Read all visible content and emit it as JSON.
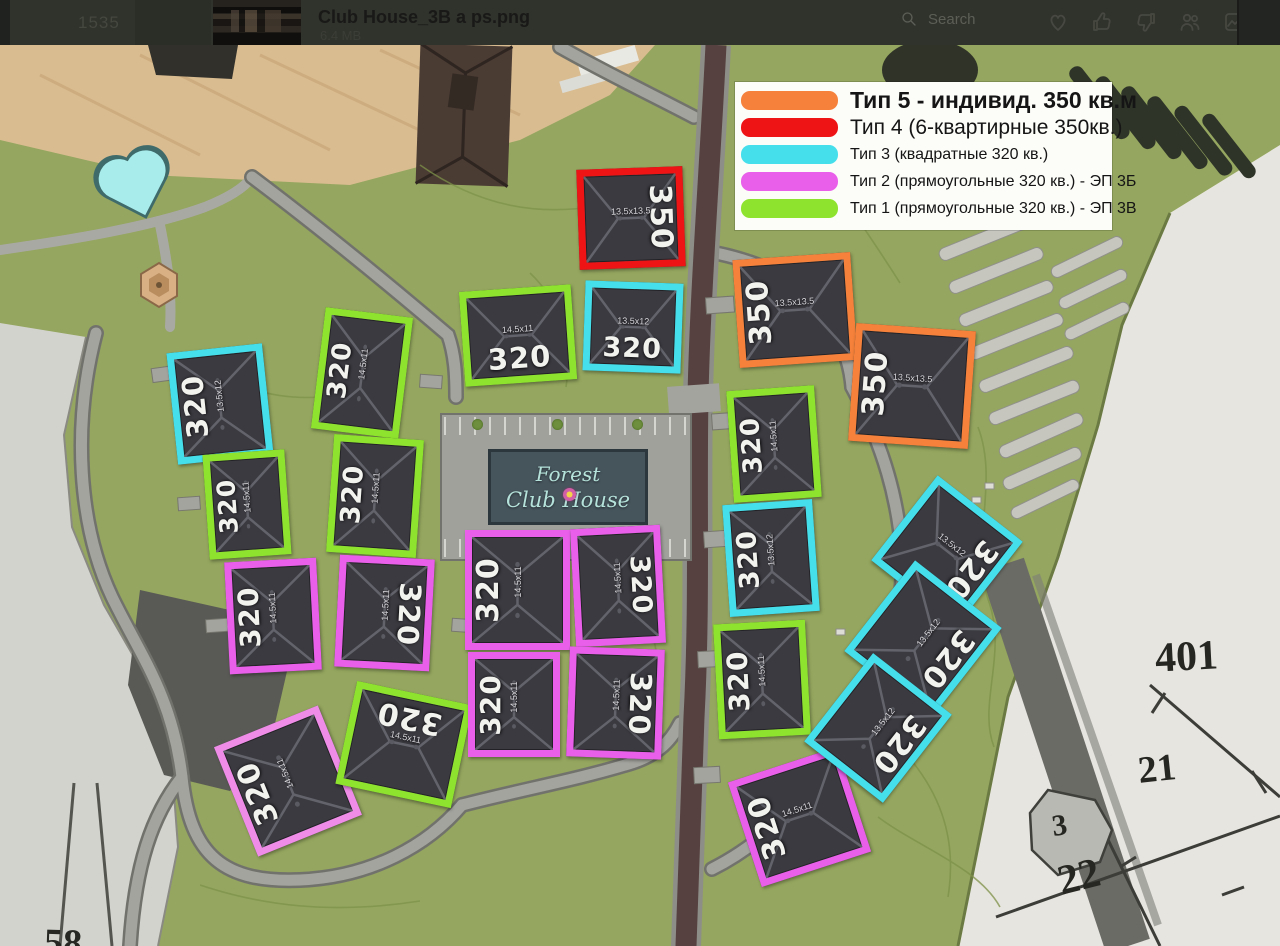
{
  "titlebar": {
    "time": "1535",
    "filename": "Club House_3B a ps.png",
    "filesize": "6.4 MB",
    "search_label": "Search",
    "icons": [
      "search-icon",
      "heart-icon",
      "thumbs-up-icon",
      "thumbs-down-icon",
      "people-icon",
      "frame-icon"
    ]
  },
  "legend": {
    "items": [
      {
        "type": "t5",
        "label": "Тип 5 - индивид. 350 кв.м"
      },
      {
        "type": "t4",
        "label": "Тип 4 (6-квартирные 350кв.)"
      },
      {
        "type": "t3",
        "label": "Тип 3 (квадратные 320 кв.)"
      },
      {
        "type": "t2",
        "label": "Тип 2 (прямоугольные 320 кв.) - ЭП 3Б"
      },
      {
        "type": "t1",
        "label": "Тип 1 (прямоугольные 320 кв.) - ЭП 3В"
      }
    ]
  },
  "types": {
    "t5": {
      "name": "Тип 5",
      "color": "#f5813a",
      "dim": "13.5x13.5"
    },
    "t4": {
      "name": "Тип 4",
      "color": "#ee1416",
      "dim": "13.5x13.5"
    },
    "t3": {
      "name": "Тип 3",
      "color": "#44dfeb",
      "dim": "13.5x12"
    },
    "t2": {
      "name": "Тип 2",
      "color": "#e95fe9",
      "dim": "14.5x11"
    },
    "t1": {
      "name": "Тип 1",
      "color": "#8ee32e",
      "dim": "14.5x11"
    }
  },
  "sign": {
    "line1": "Forest",
    "line2": "Club House"
  },
  "buildings": [
    {
      "type": "t3",
      "x": 172,
      "y": 303,
      "w": 96,
      "h": 112,
      "rot": -6,
      "label": "320",
      "lo": "v"
    },
    {
      "type": "t1",
      "x": 318,
      "y": 267,
      "w": 88,
      "h": 122,
      "rot": 7,
      "label": "320",
      "lo": "v"
    },
    {
      "type": "t1",
      "x": 462,
      "y": 243,
      "w": 112,
      "h": 95,
      "rot": -4,
      "label": "320",
      "lo": "h"
    },
    {
      "type": "t3",
      "x": 584,
      "y": 237,
      "w": 98,
      "h": 90,
      "rot": 2,
      "label": "320",
      "lo": "h"
    },
    {
      "type": "t1",
      "x": 206,
      "y": 407,
      "w": 82,
      "h": 105,
      "rot": -4,
      "label": "320",
      "lo": "v"
    },
    {
      "type": "t1",
      "x": 330,
      "y": 392,
      "w": 90,
      "h": 118,
      "rot": 4,
      "label": "320",
      "lo": "v"
    },
    {
      "type": "t2",
      "x": 227,
      "y": 515,
      "w": 92,
      "h": 112,
      "rot": -3,
      "label": "320",
      "lo": "v"
    },
    {
      "type": "t2",
      "x": 337,
      "y": 512,
      "w": 95,
      "h": 112,
      "rot": 3,
      "label": "320",
      "lo": "vf"
    },
    {
      "type": "t2",
      "x": 232,
      "y": 677,
      "w": 112,
      "h": 118,
      "rot": -22,
      "label": "320",
      "lo": "v",
      "tint": "#ef8ce8"
    },
    {
      "type": "t1",
      "x": 345,
      "y": 647,
      "w": 118,
      "h": 105,
      "rot": 12,
      "label": "320",
      "lo": "hf"
    },
    {
      "type": "t2",
      "x": 465,
      "y": 485,
      "w": 105,
      "h": 120,
      "rot": 0,
      "label": "320",
      "lo": "v"
    },
    {
      "type": "t2",
      "x": 573,
      "y": 482,
      "w": 90,
      "h": 118,
      "rot": -3,
      "label": "320",
      "lo": "vf"
    },
    {
      "type": "t2",
      "x": 468,
      "y": 607,
      "w": 92,
      "h": 105,
      "rot": 0,
      "label": "320",
      "lo": "v"
    },
    {
      "type": "t2",
      "x": 568,
      "y": 603,
      "w": 95,
      "h": 110,
      "rot": 2,
      "label": "320",
      "lo": "vf"
    },
    {
      "type": "t4",
      "x": 578,
      "y": 123,
      "w": 106,
      "h": 100,
      "rot": -2,
      "label": "350",
      "lo": "vf"
    },
    {
      "type": "t5",
      "x": 736,
      "y": 211,
      "w": 118,
      "h": 108,
      "rot": -4,
      "label": "350",
      "lo": "v"
    },
    {
      "type": "t5",
      "x": 852,
      "y": 282,
      "w": 120,
      "h": 118,
      "rot": 4,
      "label": "350",
      "lo": "v"
    },
    {
      "type": "t1",
      "x": 730,
      "y": 343,
      "w": 88,
      "h": 112,
      "rot": -4,
      "label": "320",
      "lo": "v"
    },
    {
      "type": "t3",
      "x": 726,
      "y": 457,
      "w": 90,
      "h": 112,
      "rot": -4,
      "label": "320",
      "lo": "v"
    },
    {
      "type": "t1",
      "x": 716,
      "y": 577,
      "w": 92,
      "h": 115,
      "rot": -3,
      "label": "320",
      "lo": "v"
    },
    {
      "type": "t2",
      "x": 742,
      "y": 717,
      "w": 115,
      "h": 110,
      "rot": -18,
      "label": "320",
      "lo": "v"
    },
    {
      "type": "t3",
      "x": 893,
      "y": 452,
      "w": 108,
      "h": 108,
      "rot": 38,
      "label": "320",
      "lo": "vf"
    },
    {
      "type": "t3",
      "x": 868,
      "y": 537,
      "w": 110,
      "h": 115,
      "rot": 38,
      "label": "320",
      "lo": "vf"
    },
    {
      "type": "t3",
      "x": 828,
      "y": 627,
      "w": 100,
      "h": 112,
      "rot": 38,
      "label": "320",
      "lo": "vf"
    }
  ],
  "map_labels": [
    {
      "text": "401",
      "x": 1155,
      "y": 588,
      "size": 42,
      "rot": -3
    },
    {
      "text": "21",
      "x": 1138,
      "y": 702,
      "size": 38,
      "rot": -6
    },
    {
      "text": "3",
      "x": 1052,
      "y": 764,
      "size": 30,
      "rot": -8
    },
    {
      "text": "22",
      "x": 1058,
      "y": 808,
      "size": 42,
      "rot": -14
    },
    {
      "text": "58",
      "x": 44,
      "y": 876,
      "size": 38,
      "rot": 2
    }
  ],
  "colors": {
    "grass": "#94a65f",
    "road": "#a4a49f",
    "main_road": "#564140",
    "cadastral": "#e7e5df",
    "cadastral_left": "#d3d3ce",
    "plaza": "#d9bc90",
    "pool": "#a9ecec",
    "roof": "#3a3a40",
    "sign_bg": "#46545c"
  }
}
